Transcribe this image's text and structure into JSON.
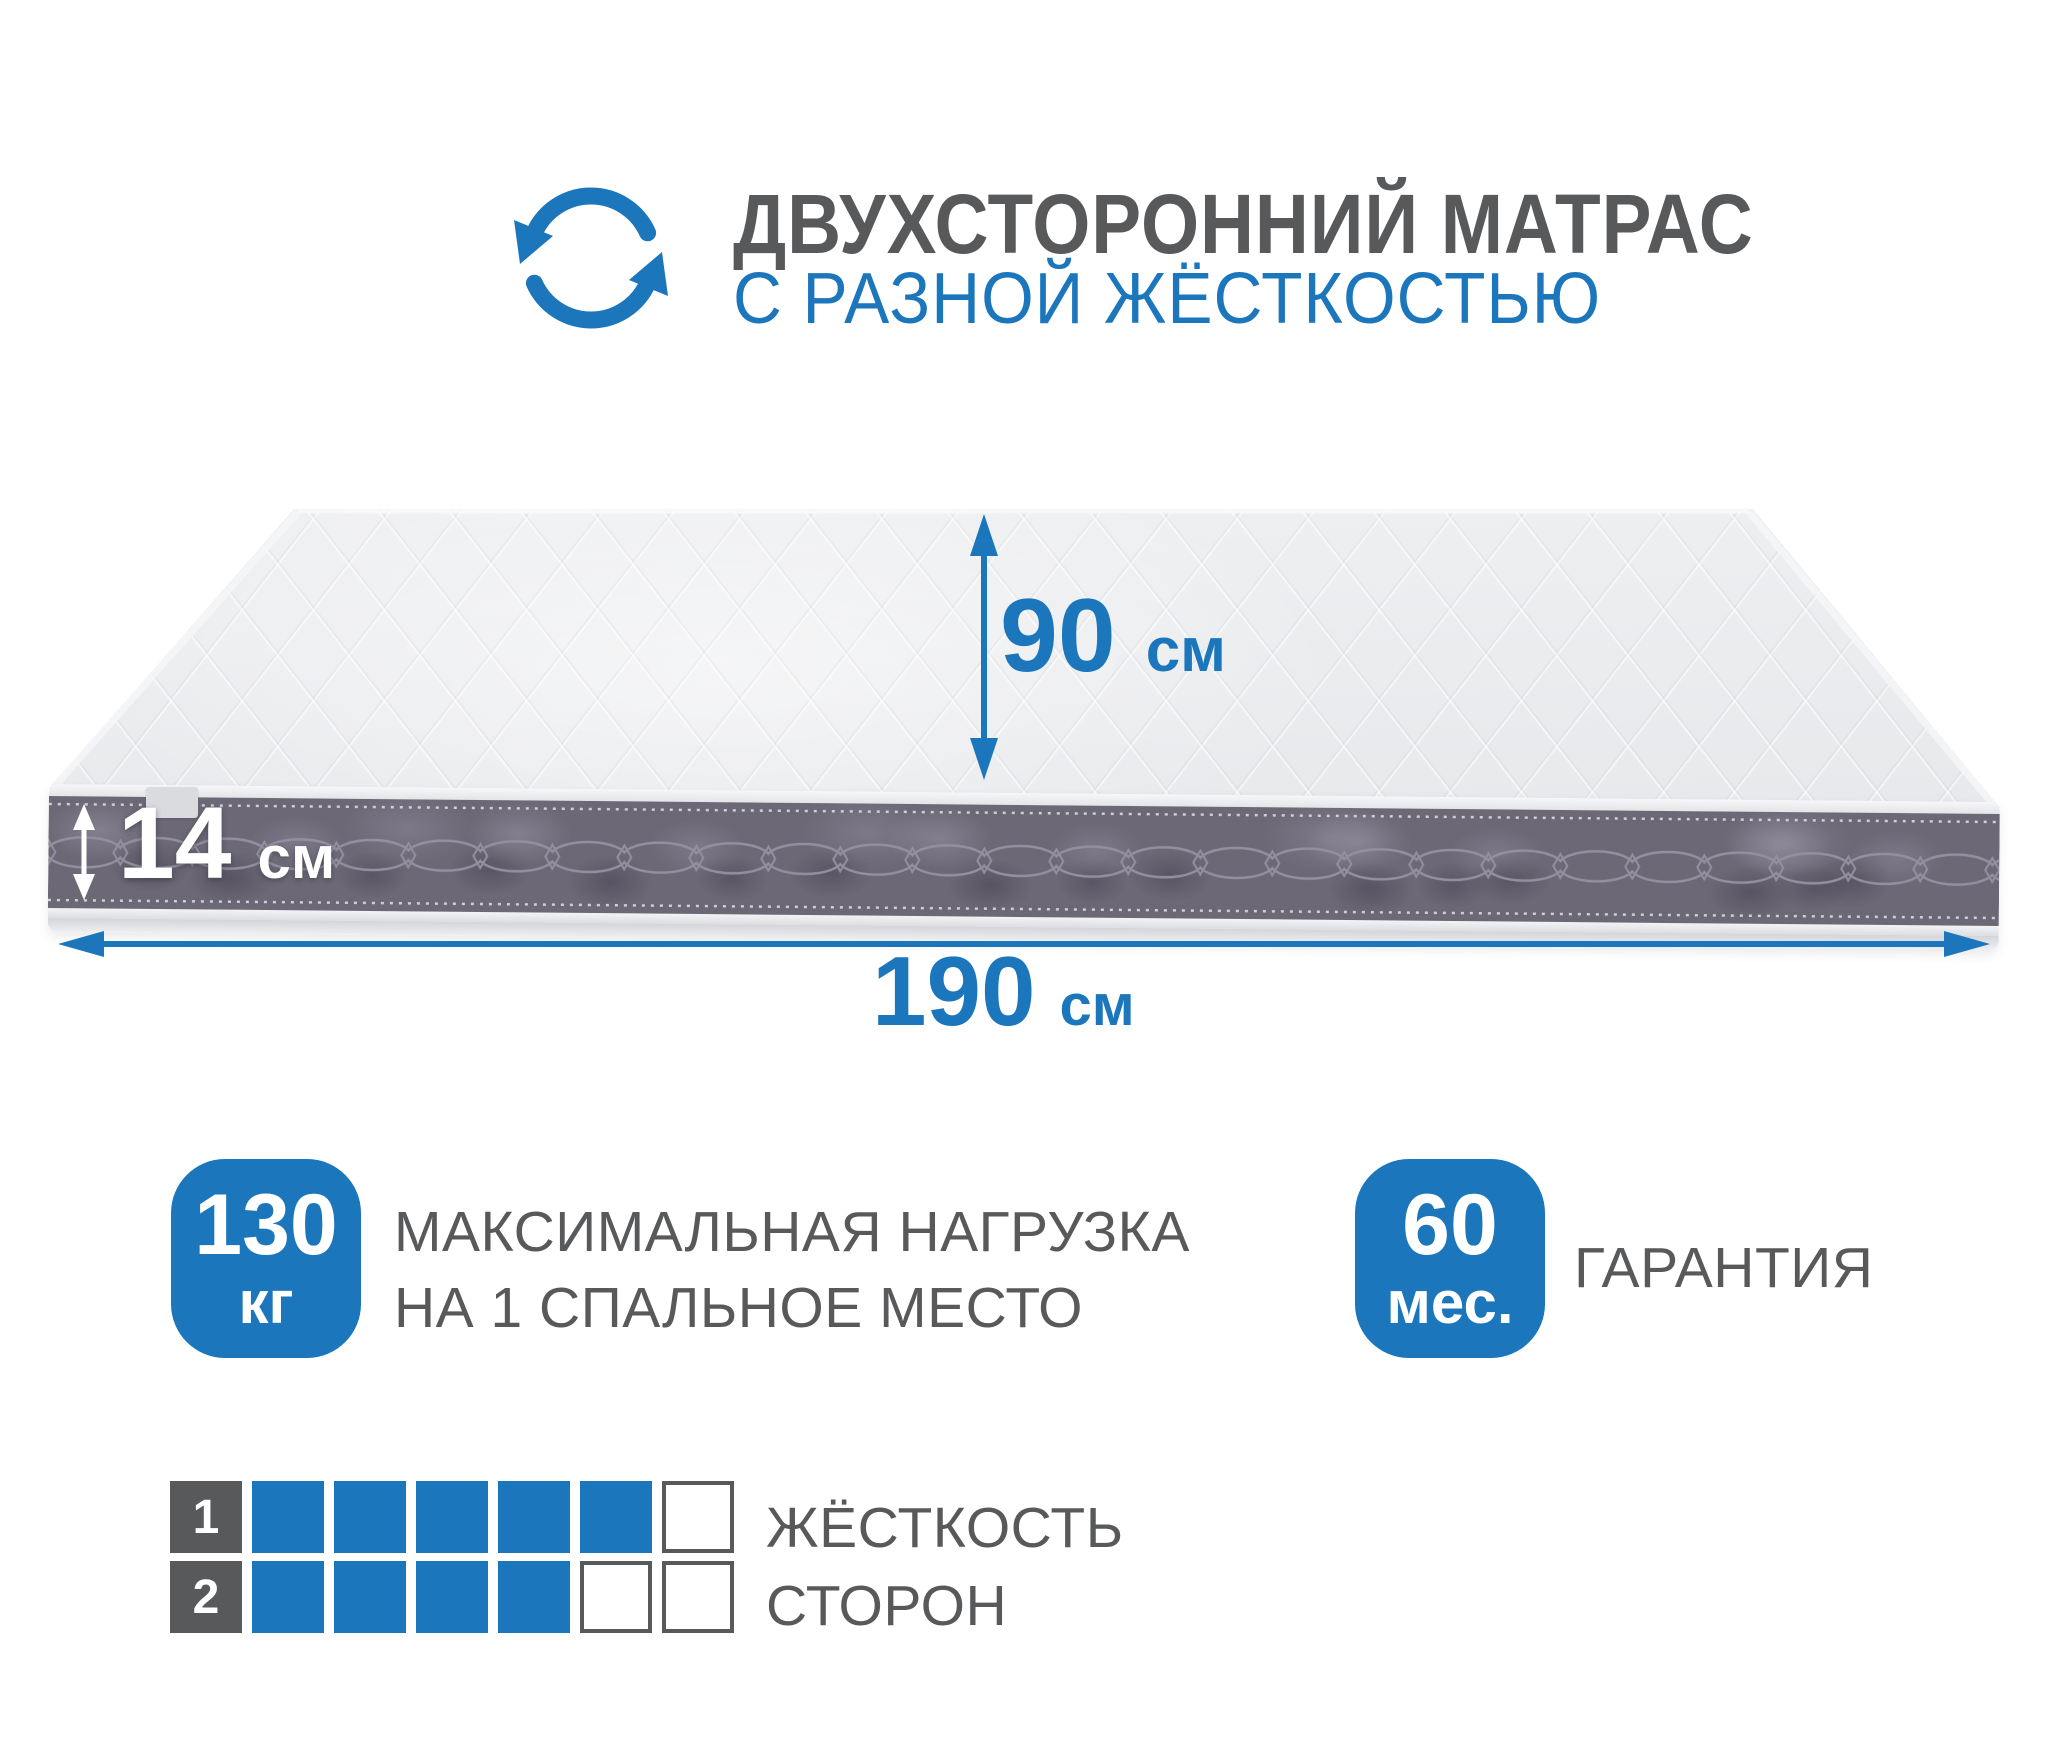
{
  "header": {
    "title_line1": "ДВУХСТОРОННИЙ МАТРАС",
    "title_line2": "С РАЗНОЙ ЖЁСТКОСТЬЮ",
    "icon": "rotate-two-sided-icon"
  },
  "dimensions": {
    "width": {
      "value": "90",
      "unit": "см"
    },
    "thickness": {
      "value": "14",
      "unit": "см"
    },
    "length": {
      "value": "190",
      "unit": "см"
    }
  },
  "badges": {
    "max_load": {
      "value": "130",
      "unit": "кг",
      "caption_line1": "МАКСИМАЛЬНАЯ НАГРУЗКА",
      "caption_line2": "НА 1 СПАЛЬНОЕ МЕСТО"
    },
    "warranty": {
      "value": "60",
      "unit": "мес.",
      "caption": "ГАРАНТИЯ"
    }
  },
  "hardness": {
    "caption_line1": "ЖЁСТКОСТЬ",
    "caption_line2": "СТОРОН",
    "scale_max": 6,
    "sides": [
      {
        "label": "1",
        "value": 5
      },
      {
        "label": "2",
        "value": 4
      }
    ]
  },
  "colors": {
    "accent_blue": "#1b76bc",
    "text_gray": "#58595b",
    "side_fabric": "#6c6876",
    "piping": "#eef0f2"
  }
}
